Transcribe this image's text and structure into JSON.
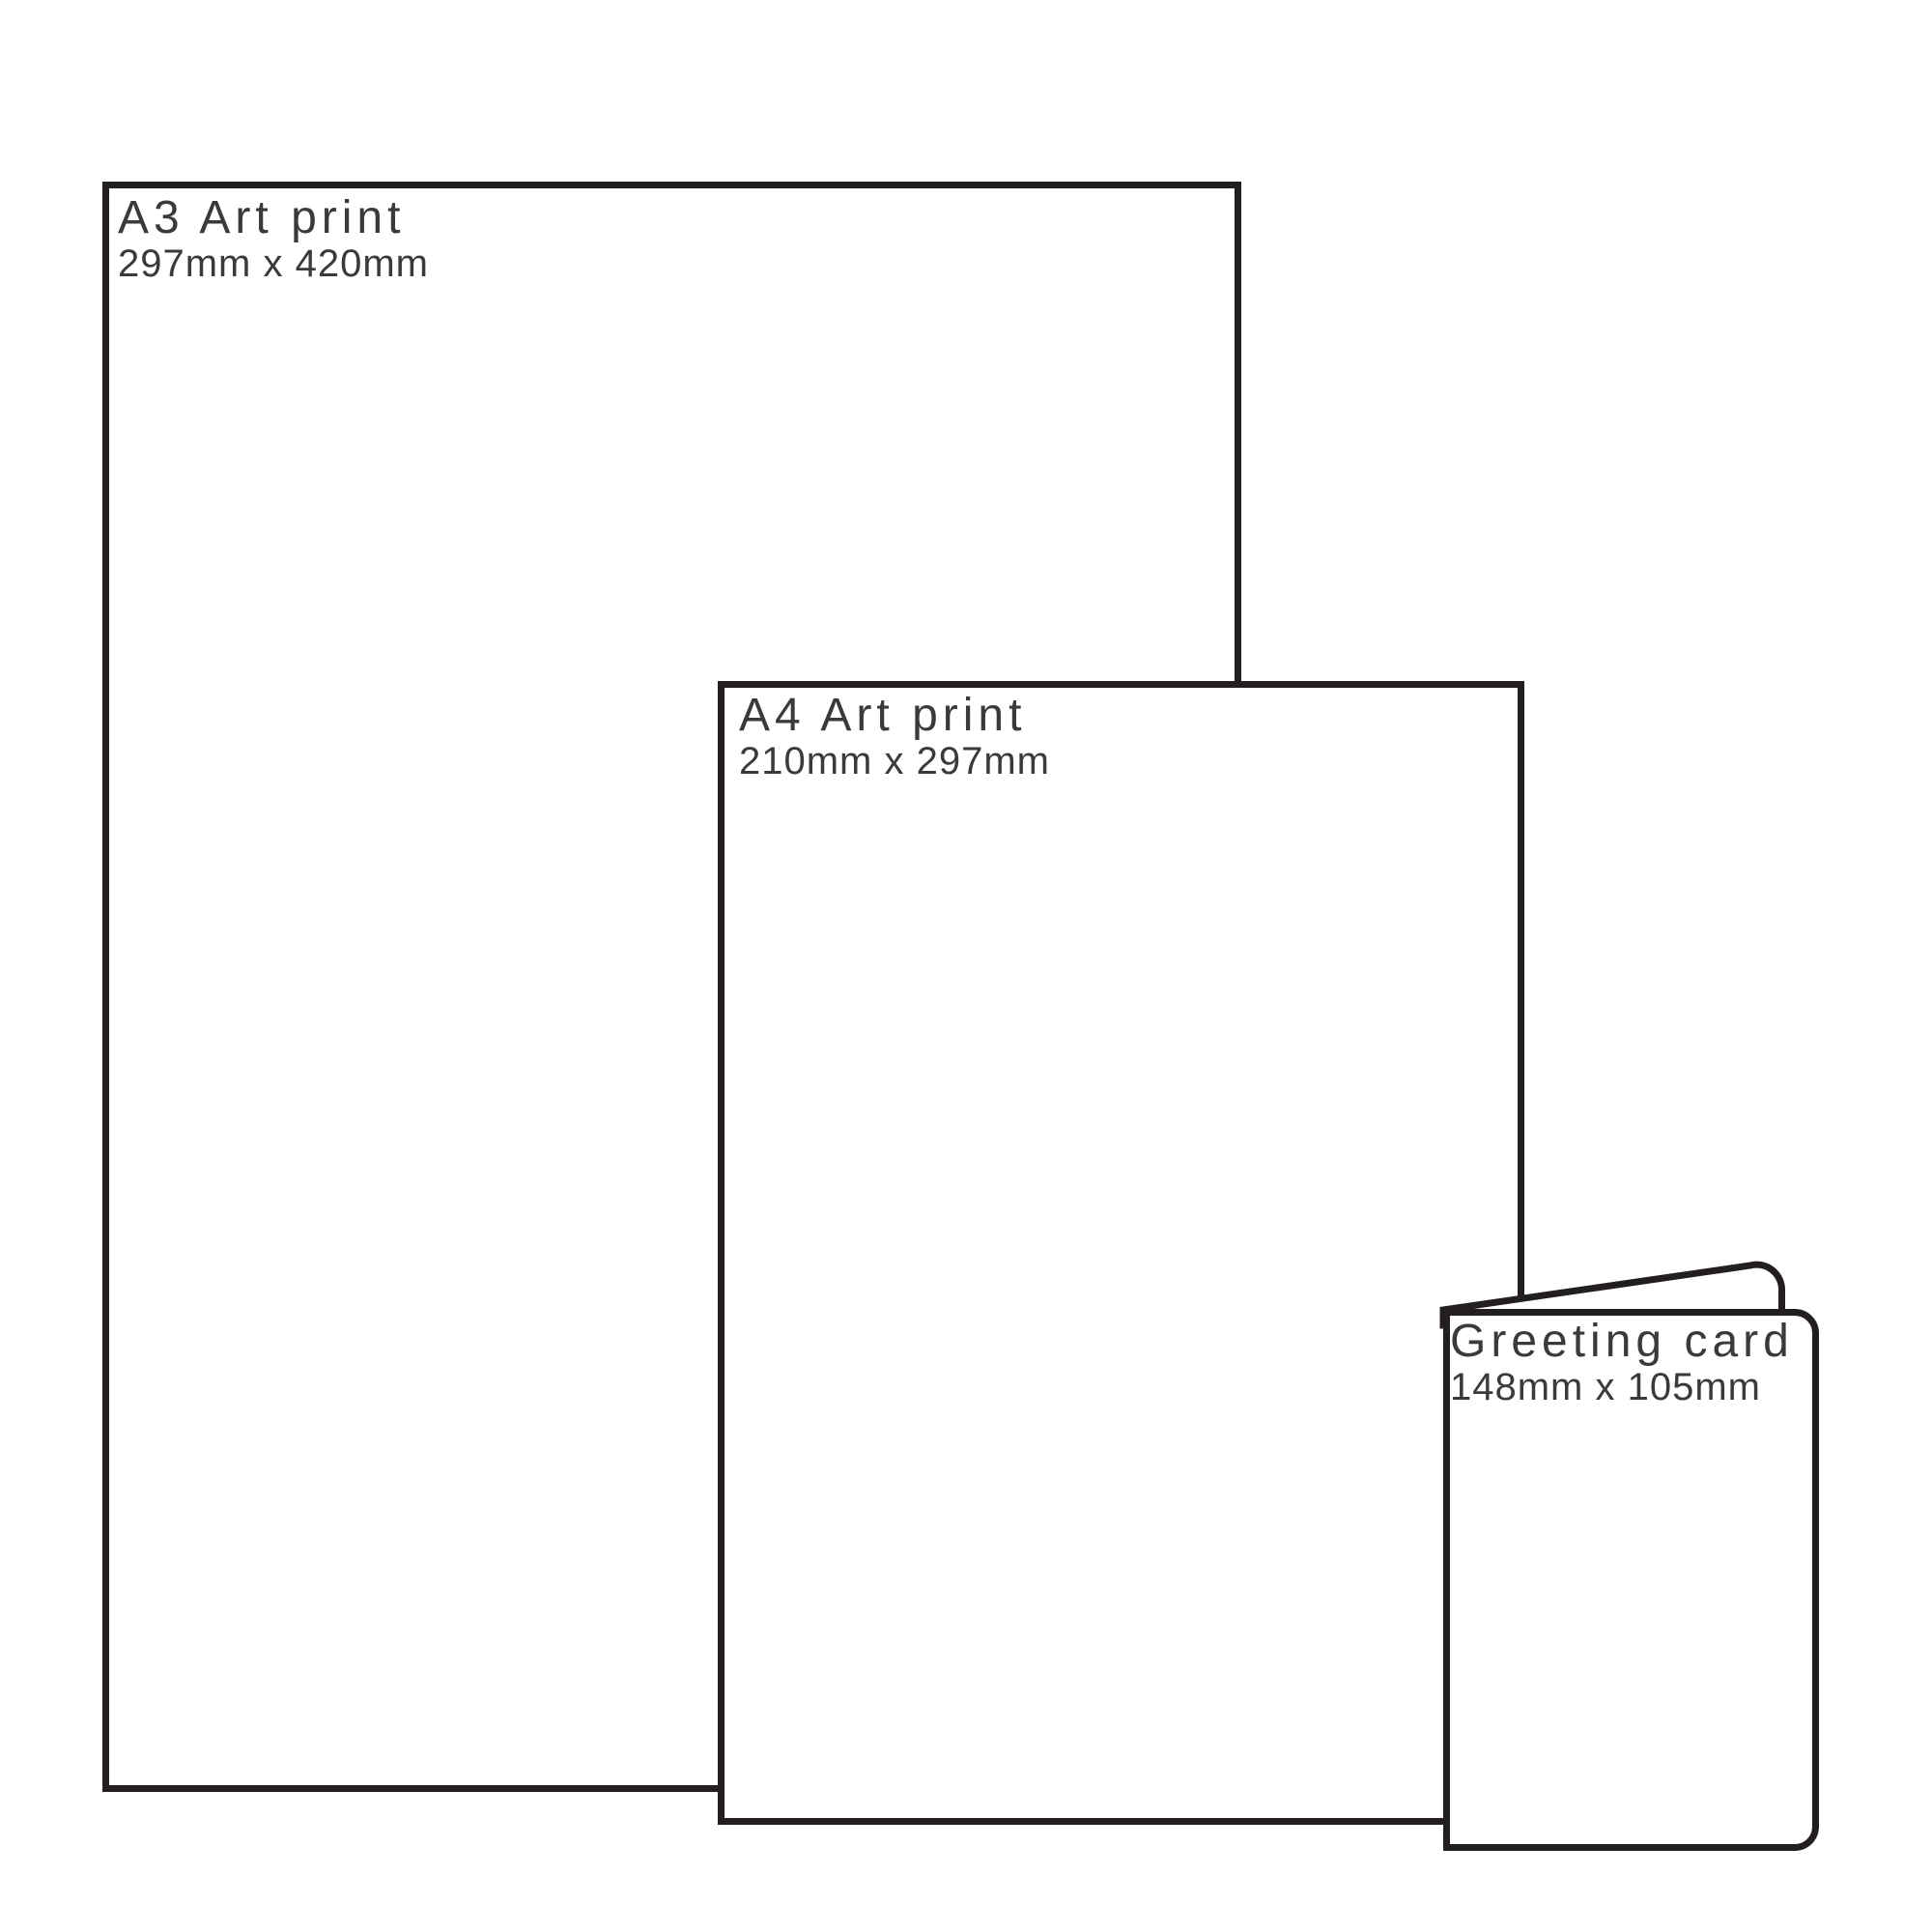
{
  "colors": {
    "outline": "#231f20",
    "text": "#3c393a",
    "background": "#ffffff"
  },
  "items": [
    {
      "id": "a3-print",
      "title": "A3 Art print",
      "dimensions": "297mm x 420mm"
    },
    {
      "id": "a4-print",
      "title": "A4 Art print",
      "dimensions": "210mm x 297mm"
    },
    {
      "id": "greeting-card",
      "title": "Greeting card",
      "dimensions": "148mm x 105mm"
    }
  ]
}
